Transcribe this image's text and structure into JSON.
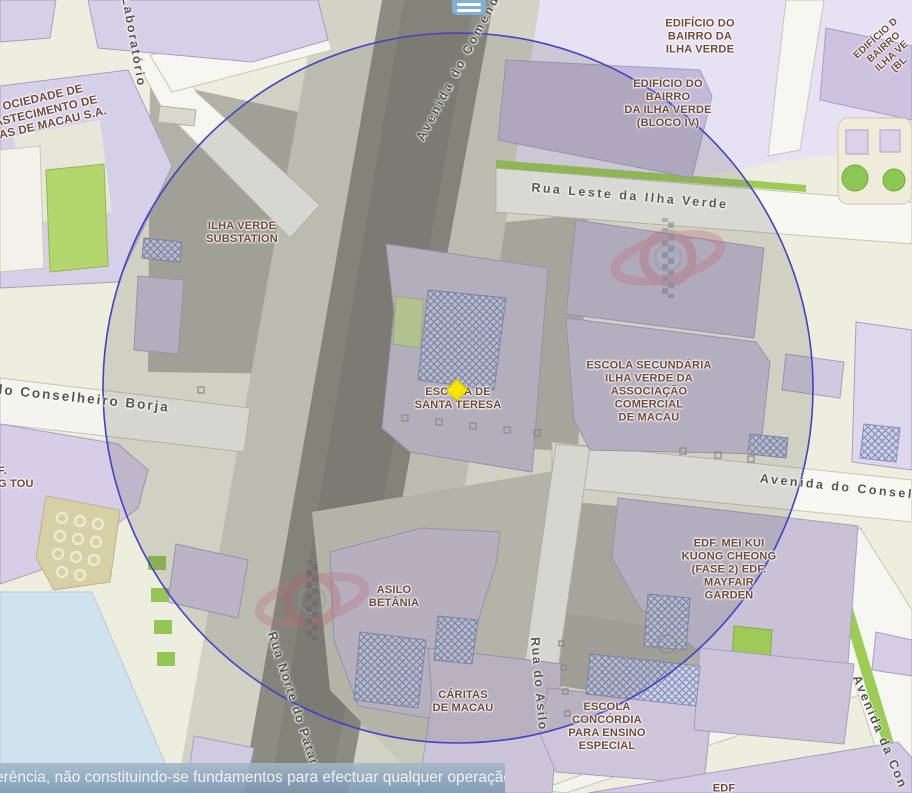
{
  "app": {
    "menu_button": "hamburger-menu",
    "footer_disclaimer": "erência, não constituindo-se fundamentos para efectuar qualquer operação."
  },
  "overlay": {
    "shape": "buffer-circle",
    "stroke_color": "#4442c4",
    "marker_color": "#f9e300"
  },
  "colors": {
    "building": "#d3cbe3",
    "road_major_dark": "#8c8c83",
    "road_light": "#f6f6f0",
    "ground": "#edeede",
    "water": "#cfe2ee",
    "green": "#9ccb56",
    "label_brown": "#6f4b38",
    "label_street_gray": "#57574f"
  },
  "streets": {
    "laboratorio": "Laboratório",
    "avenida_comendador": "Avenida do Comend",
    "rua_leste": "Rua Leste da Ilha Verde",
    "conselheiro_borja": "do Conselheiro Borja",
    "avenida_conselheiro": "Avenida do Conselh",
    "rua_asilo": "Rua do Asilo",
    "rua_norte_patane": "Rua Norte do Patane",
    "avenida_da_con": "Avenida da Con"
  },
  "places": {
    "sociedade": {
      "line1": "OCIEDADE DE",
      "line2": "ASTECIMENTO DE",
      "line3": "UAS DE MACAU S.A."
    },
    "substation": {
      "line1": "ILHA VERDE",
      "line2": "SUBSTATION"
    },
    "edificio_bairro": {
      "line1": "EDIFÍCIO DO",
      "line2": "BAIRRO DA",
      "line3": "ILHA VERDE"
    },
    "edificio_bloco_iv": {
      "line1": "EDIFÍCIO DO",
      "line2": "BAIRRO",
      "line3": "DA ILHA VERDE",
      "line4": "(BLOCO IV)"
    },
    "edificio_rot": {
      "line1": "EDIFÍCIO D",
      "line2": "BAIRRO",
      "line3": "ILHA VE",
      "line4": "(BL"
    },
    "santa_teresa": {
      "line1": "ESCOLA DE",
      "line2": "SANTA TERESA"
    },
    "secundaria": {
      "line1": "ESCOLA SECUNDÁRIA",
      "line2": "ILHA VERDE DA",
      "line3": "ASSOCIAÇÃO",
      "line4": "COMERCIAL",
      "line5": "DE MACAU"
    },
    "edf_tou": {
      "line1": "F.",
      "line2": "G TOU"
    },
    "asilo_betania": {
      "line1": "ASILO",
      "line2": "BETÂNIA"
    },
    "mei_kui": {
      "line1": "EDF. MEI KUI",
      "line2": "KUONG CHEONG",
      "line3": "(FASE 2) EDF.",
      "line4": "MAYFAIR",
      "line5": "GARDEN"
    },
    "caritas": {
      "line1": "CÁRITAS",
      "line2": "DE MACAU"
    },
    "concordia": {
      "line1": "ESCOLA",
      "line2": "CONCÓRDIA",
      "line3": "PARA ENSINO",
      "line4": "ESPECIAL"
    },
    "edf_bottom": {
      "line1": "EDF"
    }
  }
}
